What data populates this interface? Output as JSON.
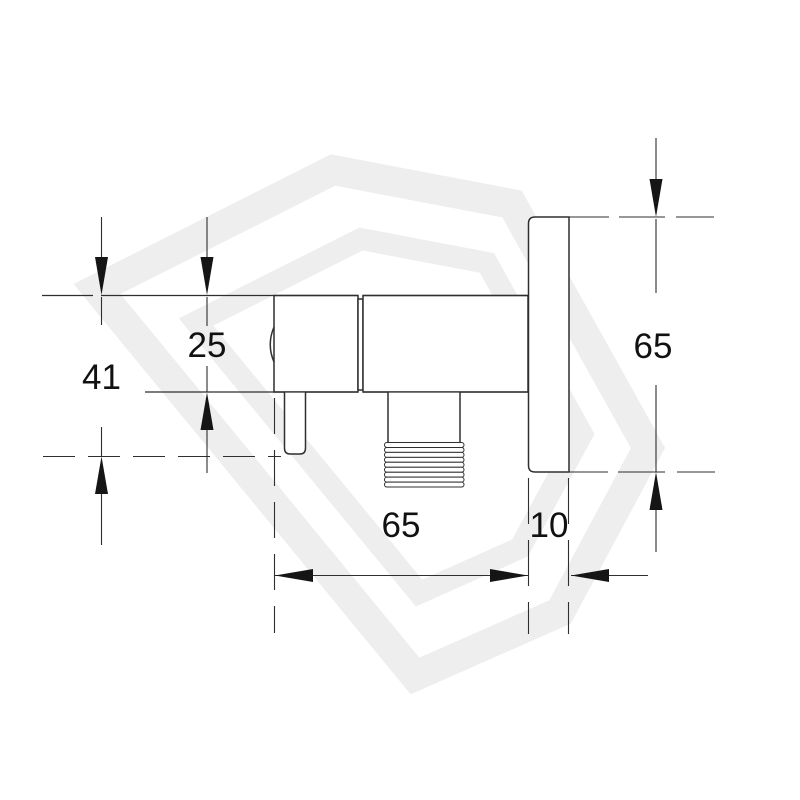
{
  "diagram": {
    "kind": "angle-valve dimension drawing, side elevation",
    "line_color": "#2f2f2f",
    "watermark_color": "#eeeeee",
    "dimensions": {
      "valve_total_height": "41",
      "valve_body_height": "25",
      "backplate_height": "65",
      "valve_length": "65",
      "backplate_thickness": "10"
    }
  }
}
